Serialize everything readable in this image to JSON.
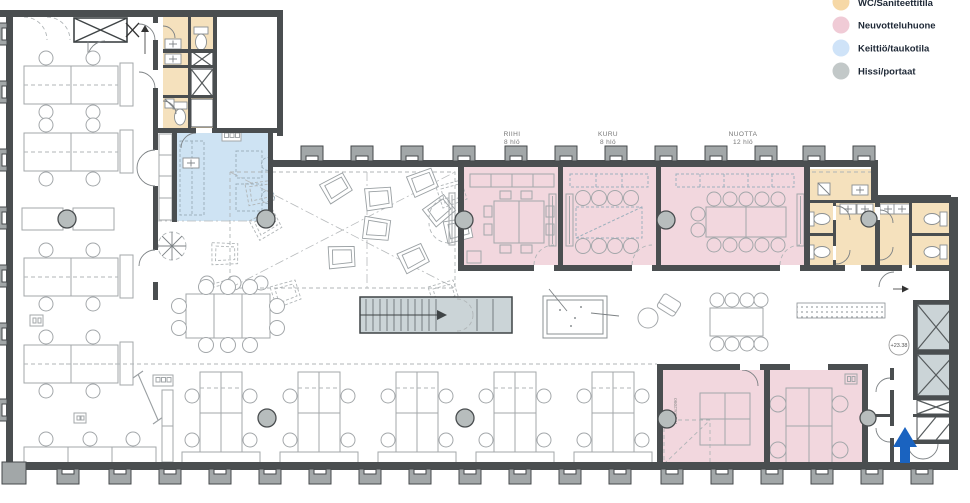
{
  "legend": {
    "items": [
      {
        "label": "WC/Saniteettitila",
        "color": "#f6d8a6"
      },
      {
        "label": "Neuvotteluhuone",
        "color": "#f0cbd6"
      },
      {
        "label": "Keittiö/taukotila",
        "color": "#cfe3f8"
      },
      {
        "label": "Hissi/portaat",
        "color": "#c2c8c8"
      }
    ]
  },
  "meeting_rooms": [
    {
      "name": "RIIHI",
      "capacity": "8 hlö"
    },
    {
      "name": "KURU",
      "capacity": "8 hlö"
    },
    {
      "name": "NUOTTA",
      "capacity": "12 hlö"
    }
  ],
  "annotations": {
    "elevation_marker": "+23.38",
    "door_code": "O24 o",
    "door_size": "K-890x2090"
  },
  "zone_colors": {
    "wc": "#f5e1bd",
    "meeting_room": "#f2d7de",
    "kitchen": "#cee3f3",
    "stairs_lift": "#cbd4d7"
  },
  "icons": {
    "entrance_arrow_color": "#1a63c0"
  }
}
